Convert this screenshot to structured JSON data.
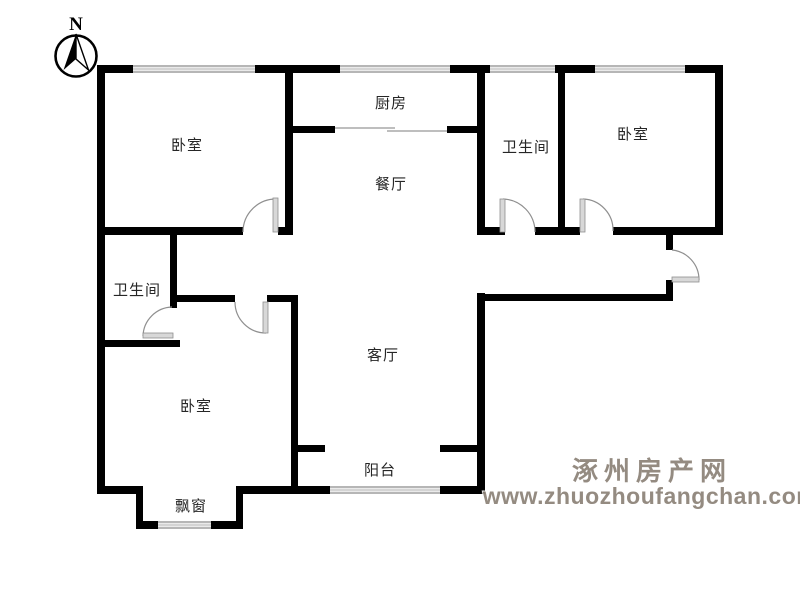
{
  "compass": {
    "direction_label": "N"
  },
  "rooms": {
    "bedroom_top_left": {
      "label": "卧室"
    },
    "kitchen": {
      "label": "厨房"
    },
    "dining_room": {
      "label": "餐厅"
    },
    "bathroom_right": {
      "label": "卫生间"
    },
    "bedroom_top_right": {
      "label": "卧室"
    },
    "bathroom_left": {
      "label": "卫生间"
    },
    "bedroom_bottom_left": {
      "label": "卧室"
    },
    "living_room": {
      "label": "客厅"
    },
    "balcony": {
      "label": "阳台"
    },
    "bay_window": {
      "label": "飘窗"
    }
  },
  "watermark": {
    "site_name": "涿州房产网",
    "site_url": "www.zhuozhoufangchan.com"
  },
  "colors": {
    "wall": "#000000",
    "door": "#d8d8d8",
    "label_text": "#262626",
    "watermark": "#8f857b",
    "background": "#ffffff"
  }
}
